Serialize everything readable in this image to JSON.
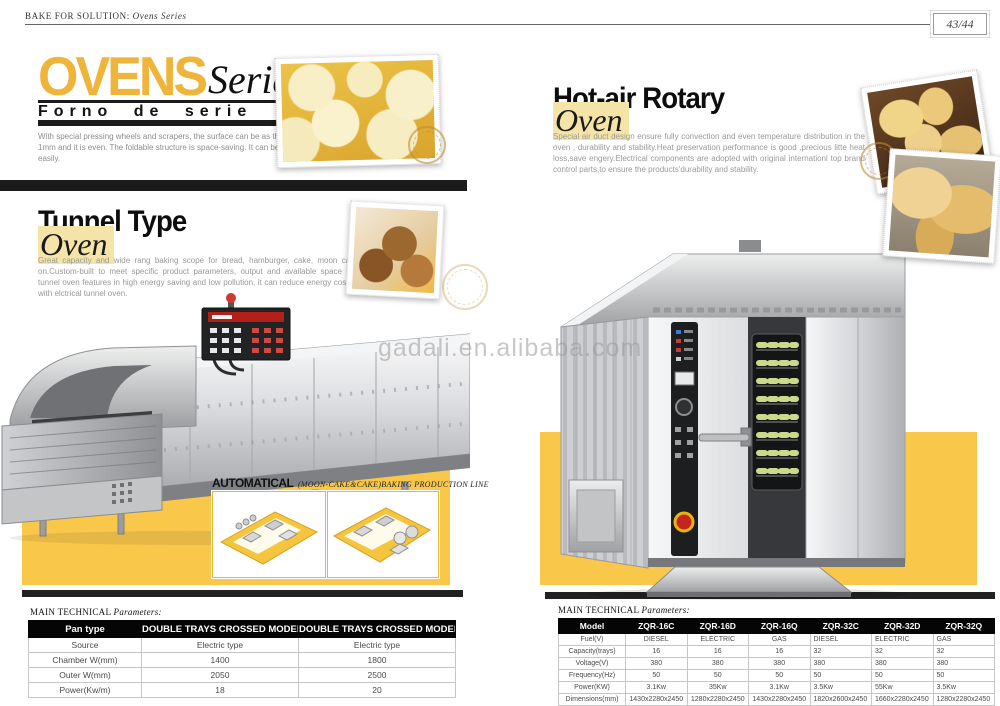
{
  "header": {
    "brand": "BAKE FOR SOLUTION:",
    "series": "Ovens Series",
    "page_number": "43/44"
  },
  "series_title": {
    "main": "OVENS",
    "accent": "Series",
    "subtitle": "Forno de serie",
    "intro": "With special pressing wheels and scrapers, the surface can be as thin as 1mm and it is even. The foldable structure is space-saving. It can be moved easily."
  },
  "tunnel": {
    "heading": "Tunnel Type",
    "accent": "Oven",
    "body": "Great capacity and wide rang baking scope for bread, hamburger, cake, moon cake, and biscuit and so on.Custom-built to meet specific product parameters, output and available space requirement.Our infrared tunnel oven features in high energy saving and low pollution, it can reduce energy cost over one half compared with elctrical tunnel oven.",
    "automatical_label": "AUTOMATICAL",
    "automatical_caption": "(MOON-CAKE&CAKE)BAKING PRODUCTION LINE",
    "table_title": "MAIN TECHNICAL",
    "table_title_accent": "Parameters:",
    "table": {
      "headers": [
        "Pan type",
        "DOUBLE TRAYS CROSSED MODEL",
        "DOUBLE TRAYS CROSSED MODEL"
      ],
      "rows": [
        [
          "Source",
          "Electric type",
          "Electric type"
        ],
        [
          "Chamber W(mm)",
          "1400",
          "1800"
        ],
        [
          "Outer W(mm)",
          "2050",
          "2500"
        ],
        [
          "Power(Kw/m)",
          "18",
          "20"
        ]
      ]
    }
  },
  "rotary": {
    "heading": "Hot-air Rotary",
    "accent": "Oven",
    "body": "Special air duct design ensure fully convection and even temperature distribution in the oven , durability and stability.Heat preservation performance is good ,precious litte heat loss,save engery.Electrical components are adopted with original internationl top brand control parts,to ensure the products'durability and stability.",
    "watermark": "gadali.en.alibaba.com",
    "table_title": "MAIN TECHNICAL",
    "table_title_accent": "Parameters:",
    "table": {
      "headers": [
        "Model",
        "ZQR-16C",
        "ZQR-16D",
        "ZQR-16Q",
        "ZQR-32C",
        "ZQR-32D",
        "ZQR-32Q"
      ],
      "rows": [
        [
          "Fuel(V)",
          "DIESEL",
          "ELECTRIC",
          "GAS",
          "DIESEL",
          "ELECTRIC",
          "GAS"
        ],
        [
          "Capacity(trays)",
          "16",
          "16",
          "16",
          "32",
          "32",
          "32"
        ],
        [
          "Voltage(V)",
          "380",
          "380",
          "380",
          "380",
          "380",
          "380"
        ],
        [
          "Frequency(Hz)",
          "50",
          "50",
          "50",
          "50",
          "50",
          "50"
        ],
        [
          "Power(KW)",
          "3.1Kw",
          "35Kw",
          "3.1Kw",
          "3.5Kw",
          "55Kw",
          "3.5Kw"
        ],
        [
          "Dimensions(mm)",
          "1430x2280x2450",
          "1280x2280x2450",
          "1430x2280x2450",
          "1820x2600x2450",
          "1660x2280x2450",
          "1280x2280x2450"
        ]
      ]
    }
  },
  "colors": {
    "brand_yellow": "#F9C74A",
    "title_yellow": "#EFB43A",
    "highlight_yellow": "#F4E4A8",
    "bar_black": "#1B1B1B"
  }
}
